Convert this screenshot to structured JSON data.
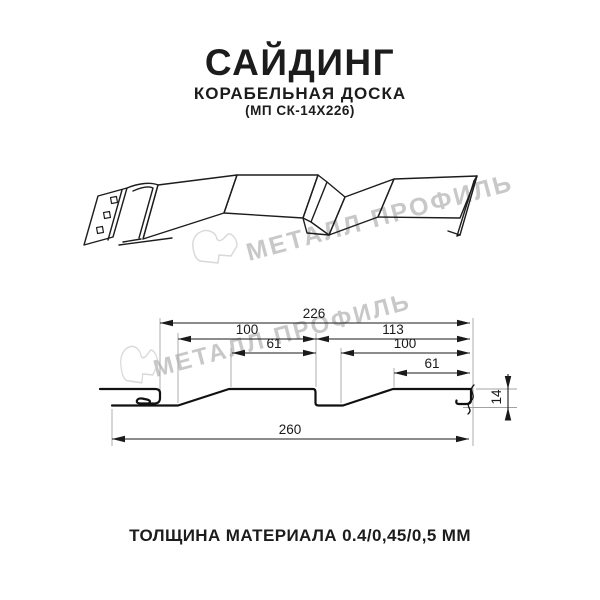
{
  "header": {
    "title": "САЙДИНГ",
    "subtitle": "КОРАБЕЛЬНАЯ ДОСКА",
    "model_code": "(МП СК-14Х226)"
  },
  "watermark": {
    "text": "МЕТАЛЛ ПРОФИЛЬ",
    "text_color": "#c8c8c8",
    "logo_color": "#d8d8d8"
  },
  "footer": {
    "thickness": "ТОЛЩИНА МАТЕРИАЛА 0.4/0,45/0,5 ММ"
  },
  "drawing": {
    "type": "technical-drawing",
    "product": "siding ship-board profile, isometric view and cross-section",
    "dim_labels": {
      "d226": "226",
      "d100_left": "100",
      "d61_left": "61",
      "d113": "113",
      "d100_right": "100",
      "d61_right": "61",
      "d260": "260",
      "d14": "14"
    },
    "dimensions_mm": {
      "cover_width": 226,
      "overall_width": 260,
      "profile_height": 14,
      "left_panel_pitch": 100,
      "left_panel_flat": 61,
      "right_panel_span": 113,
      "right_panel_pitch": 100,
      "right_panel_flat": 61
    }
  },
  "colors": {
    "drawing_line": "#1d1d1d",
    "dimension_line": "#1a1a1a",
    "extension_line": "#a3a3a3",
    "text": "#1c1c1c"
  }
}
